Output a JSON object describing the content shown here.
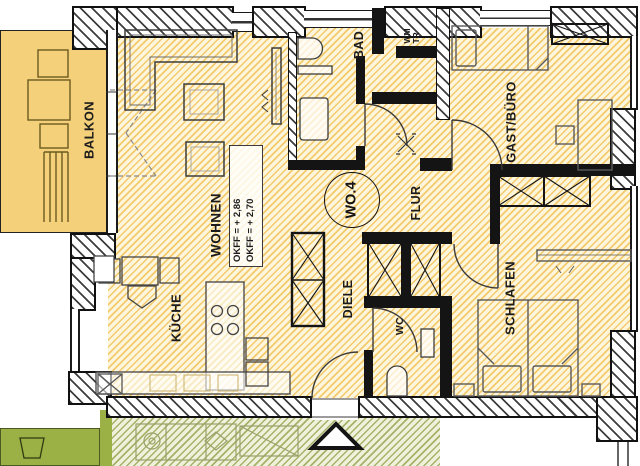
{
  "plan": {
    "unit_label": "WO.4",
    "rooms": {
      "balkon": "BALKON",
      "wohnen": "WOHNEN",
      "kueche": "KÜCHE",
      "bad": "BAD",
      "flur": "FLUR",
      "diele": "DIELE",
      "wc": "WC",
      "schlafen": "SCHLAFEN",
      "gast_buero": "GAST/BÜRO",
      "wm": "WM",
      "tr": "TR"
    },
    "annotations": {
      "okff_1": "OKFF = + 2,86",
      "okff_2": "OKFF = + 2,70"
    },
    "colors": {
      "floor_hatch": "#F2C45C",
      "balcony_fill": "#F5D07A",
      "terrace_fill": "#9CB145",
      "wall": "#141414"
    }
  }
}
